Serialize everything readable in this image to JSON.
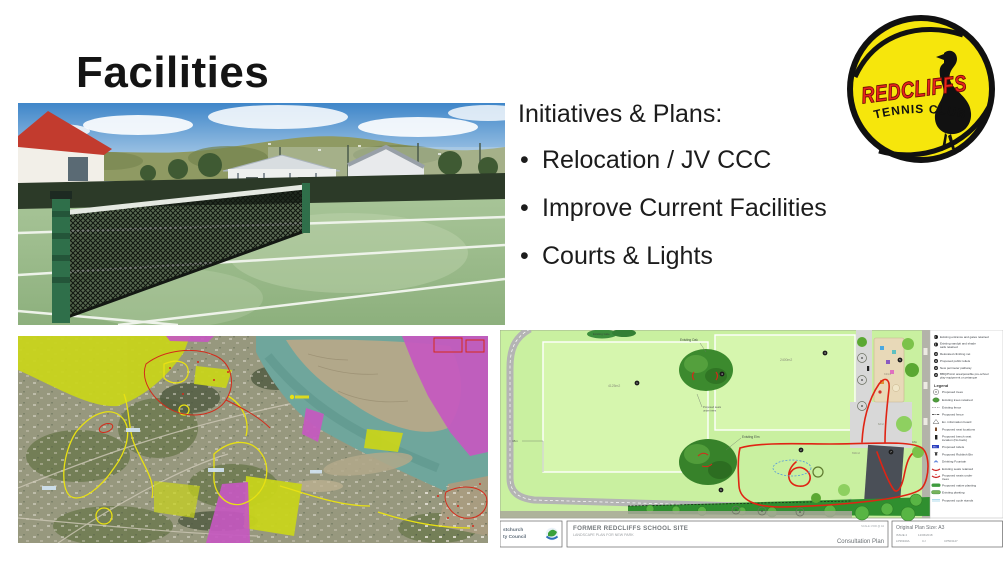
{
  "slide": {
    "title": "Facilities"
  },
  "initiatives": {
    "heading": "Initiatives & Plans:",
    "bullet_char": "•",
    "bullets": [
      "Relocation / JV CCC",
      "Improve Current Facilities",
      "Courts & Lights"
    ]
  },
  "logo": {
    "club_name": "REDCLIFFS",
    "club_type": "TENNIS CLUB",
    "ball_color": "#f6e60c",
    "name_color": "#e8251c"
  },
  "plan": {
    "labels": {
      "existing_gate": "Existing Gate",
      "existing_oak": "Existing Oak",
      "existing_elm": "Existing Elm",
      "seats_line1": "Proposed seats",
      "seats_line2": "under trees",
      "area_main": "4125m2",
      "area_second": "2400m2",
      "area_building": "690m2",
      "area_playground": "340m2",
      "area_small": "62m2",
      "dim_left": "38m",
      "dim_right": "18m"
    },
    "markers": [
      "1",
      "2",
      "3",
      "4",
      "5",
      "6",
      "7"
    ],
    "legend": {
      "heading": "Legend",
      "notes": [
        {
          "num": "8",
          "text": "Existing entrance and gates retained"
        },
        {
          "num": "9",
          "text": "Existing sandpit and shade",
          "text2": "sails retained"
        },
        {
          "num": "10",
          "text": "Relocated climbing net"
        },
        {
          "num": "11",
          "text": "Proposed public toilets"
        },
        {
          "num": "12",
          "text": "New perimeter pathway"
        },
        {
          "num": "13",
          "text": "BBQ/Picnic area/possible pre-school",
          "text2": "play equipment or petanque"
        }
      ],
      "items": [
        {
          "label": "Proposed trees"
        },
        {
          "label": "Existing trees retained"
        },
        {
          "label": "Existing fence"
        },
        {
          "label": "Proposed fence"
        },
        {
          "label": "Ex. information board"
        },
        {
          "label": "Proposed seat locations"
        },
        {
          "label": "Proposed bench seat",
          "label2": "location (No back)"
        },
        {
          "label": "Proposed toilets"
        },
        {
          "label": "Proposed Rubbish Bin"
        },
        {
          "label": "Drinking Fountain"
        },
        {
          "label": "Existing seats retained"
        },
        {
          "label": "Proposed seats under",
          "label2": "trees"
        },
        {
          "label": "Proposed native planting"
        },
        {
          "label": "Existing planting"
        },
        {
          "label": "Proposed cycle stands"
        }
      ]
    },
    "titleblock": {
      "council_line1": "stchurch",
      "council_line2": "ty Council",
      "title": "FORMER REDCLIFFS SCHOOL SITE",
      "subtitle": "LANDSCAPE PLAN FOR NEW PARK",
      "scale": "SCALE 1:500 @ A3",
      "plan_type": "Consultation Plan",
      "size_label": "Original Plan Size: A3",
      "issue": "ISSUE 2",
      "issue_date": "12/06/2018",
      "ref_a": "LP36940A",
      "ref_b": "CJ",
      "ref_c": "CP503127"
    }
  },
  "colors": {
    "plan_field": "#c9f0a0",
    "annotation_red": "#e02414",
    "map_highlight_green": "#c8d41c",
    "map_zone_magenta": "#c558c0"
  }
}
